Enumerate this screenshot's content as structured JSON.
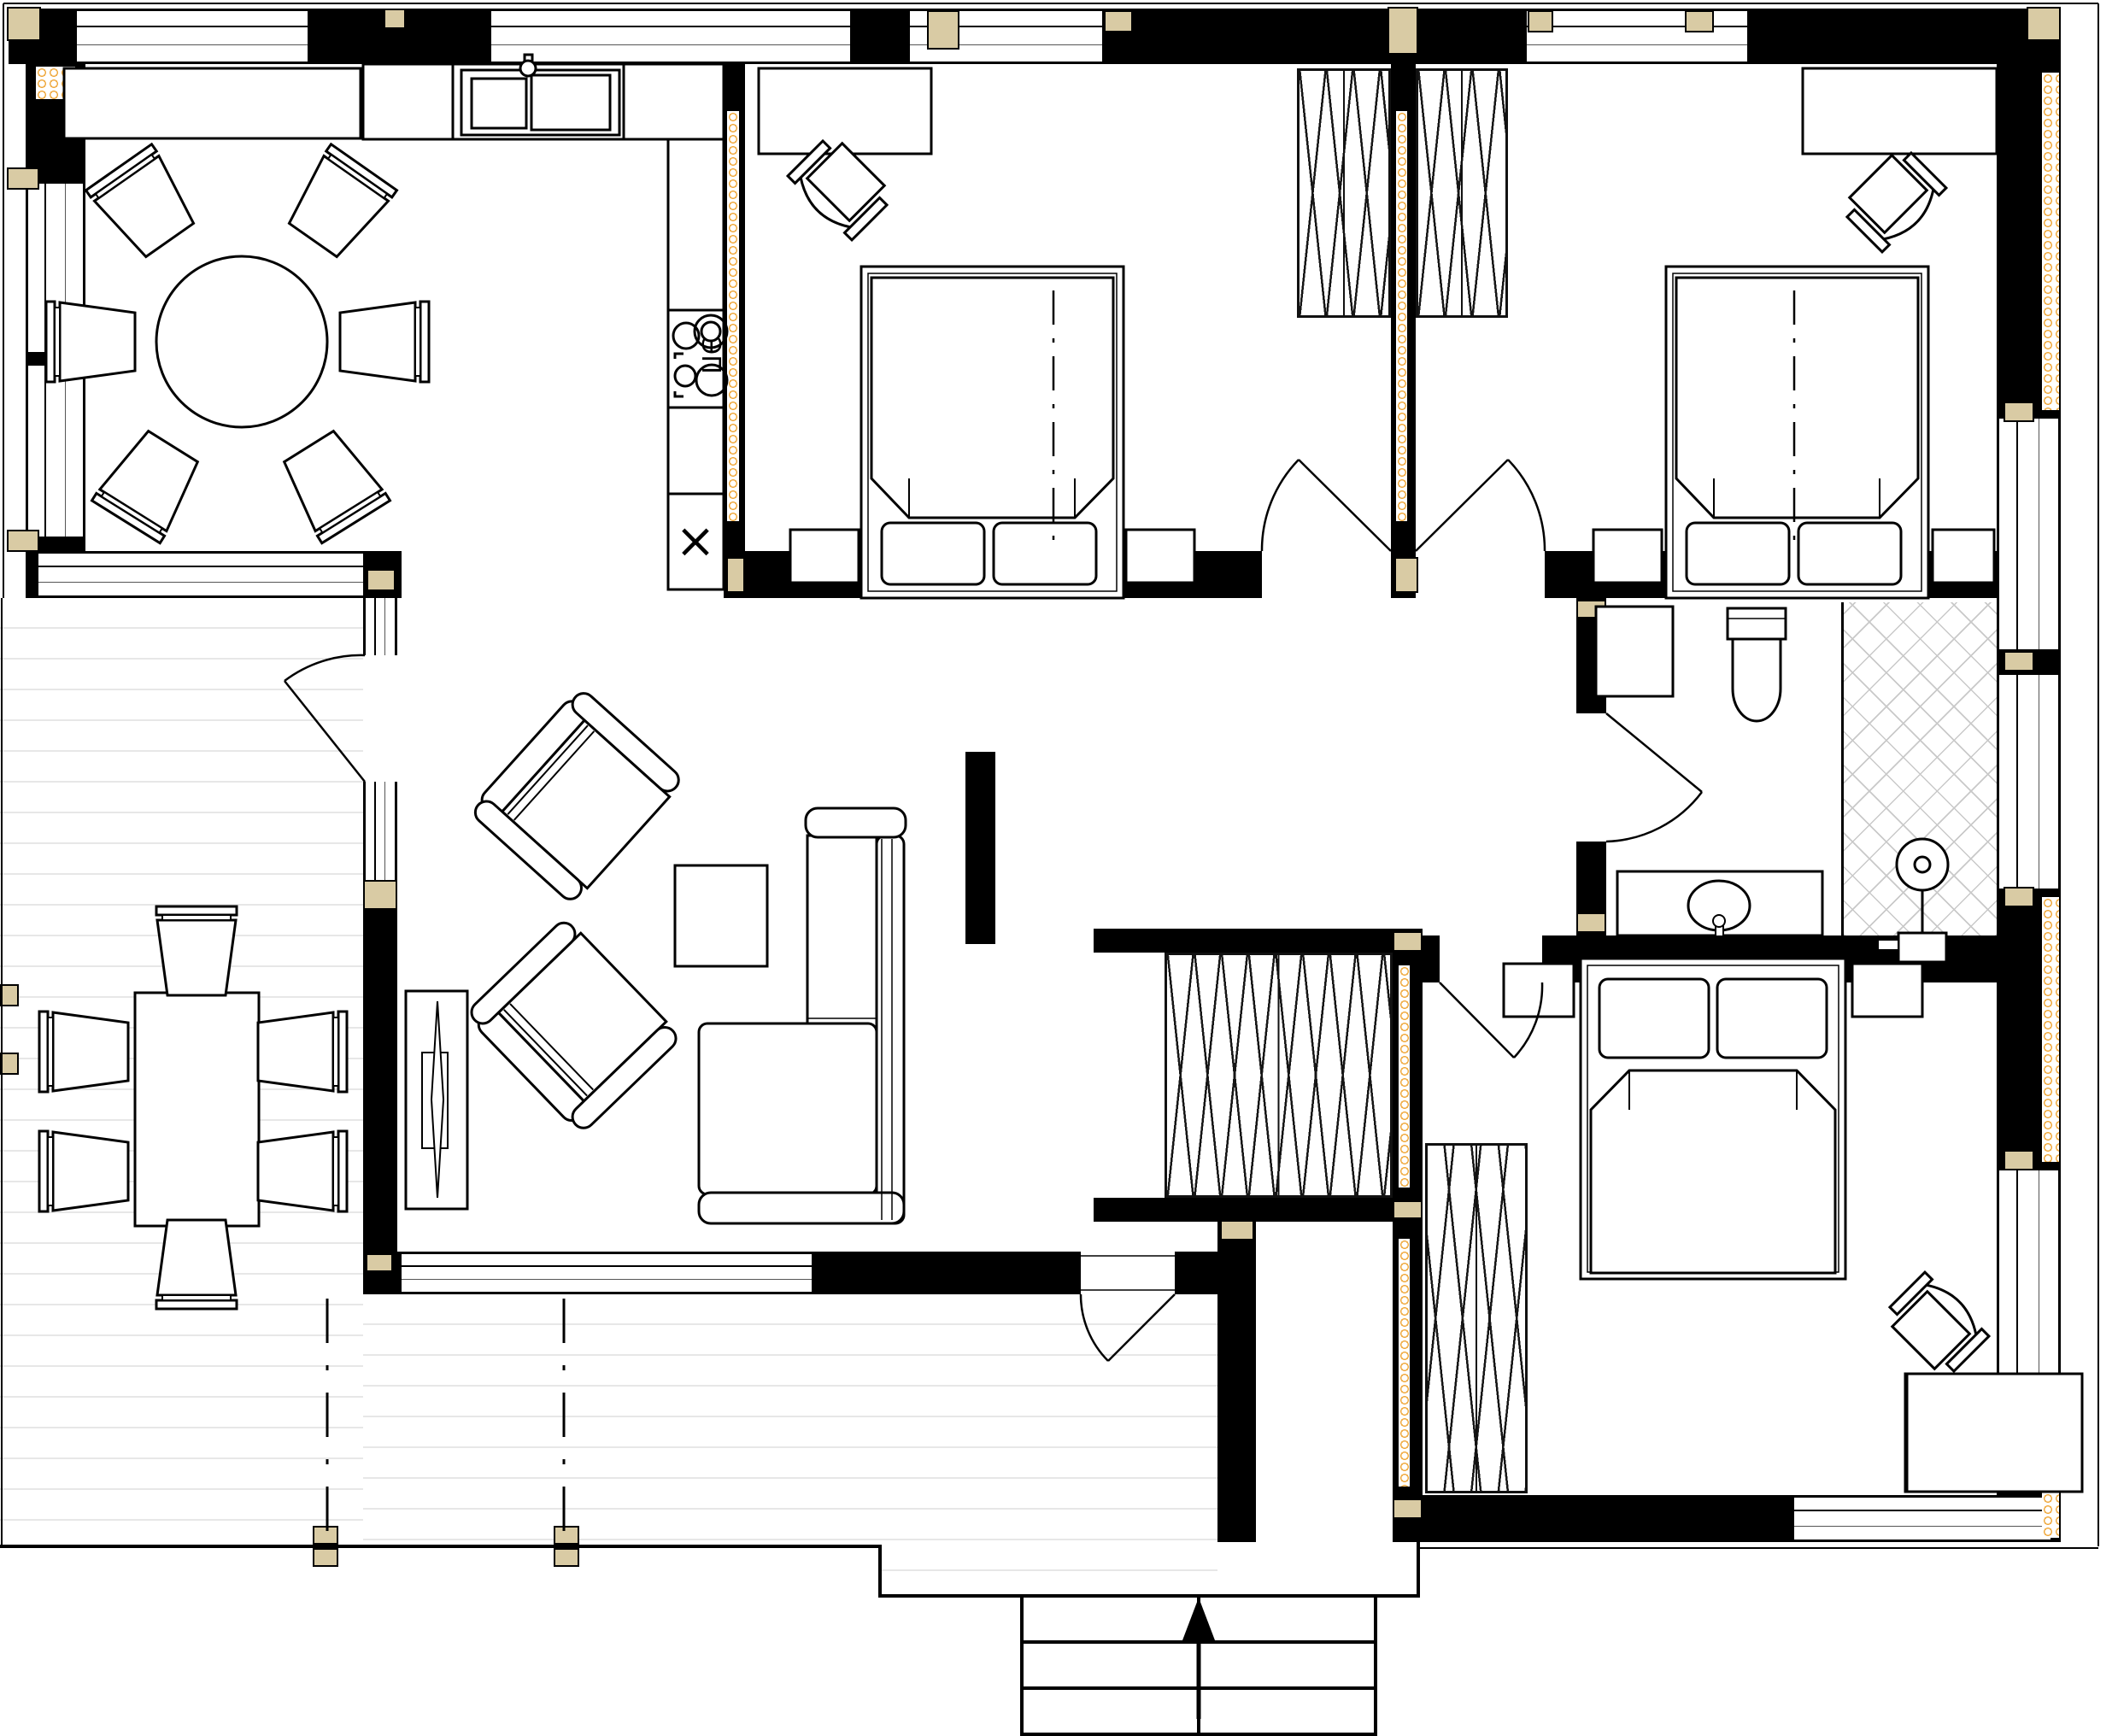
{
  "labels": {
    "stove": "ЭП",
    "appliance_cross": "×"
  },
  "palette": {
    "wall": "#000000",
    "timber_post": "#d9cba4",
    "insulation": "#efa93e",
    "deck_plank_line": "#e7e7e7",
    "wardrobe_hatch_line": "#161616",
    "tile_hatch_line": "#c9c9c9",
    "background": "#ffffff"
  },
  "plan": {
    "type": "single-storey house floor plan, top-down architectural drawing",
    "rooms": [
      {
        "name": "dining-room",
        "furniture": [
          "sideboard",
          "round-dining-table",
          "dining-chair x6"
        ]
      },
      {
        "name": "kitchen",
        "furniture": [
          "counter-with-double-sink-and-faucet",
          "cooktop-4-burners",
          "appliance-box-x"
        ]
      },
      {
        "name": "bedroom-top-middle",
        "furniture": [
          "desk",
          "office-chair",
          "double-bed",
          "pillow x2",
          "nightstand x2",
          "built-in-wardrobe"
        ]
      },
      {
        "name": "bedroom-top-right",
        "furniture": [
          "desk",
          "office-chair",
          "double-bed",
          "pillow x2",
          "nightstand x2",
          "built-in-wardrobe"
        ]
      },
      {
        "name": "living-room",
        "furniture": [
          "armchair x2",
          "coffee-table",
          "corner-sofa",
          "tv-console"
        ]
      },
      {
        "name": "hallway",
        "furniture": [
          "built-in-wardrobe"
        ]
      },
      {
        "name": "bathroom",
        "furniture": [
          "cabinet",
          "toilet",
          "vanity-with-oval-sink",
          "tiled-shower-area",
          "shower-fixture"
        ]
      },
      {
        "name": "bedroom-bottom-right",
        "furniture": [
          "double-bed",
          "pillow x2",
          "nightstand x2",
          "built-in-wardrobe",
          "desk",
          "office-chair"
        ]
      },
      {
        "name": "deck-terrace",
        "furniture": [
          "outdoor-dining-table",
          "outdoor-chair x6"
        ]
      },
      {
        "name": "entrance-porch",
        "furniture": [
          "entrance-steps",
          "up-arrow"
        ]
      }
    ],
    "icons": [
      "up-arrow",
      "cross-mark",
      "shower-head",
      "faucet",
      "door-swing-arc"
    ]
  }
}
